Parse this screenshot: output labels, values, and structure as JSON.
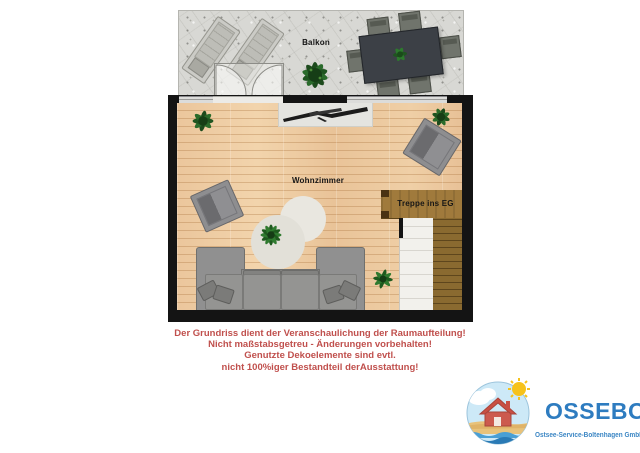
{
  "plan": {
    "labels": {
      "balcony": "Balkon",
      "living_room": "Wohnzimmer",
      "stairs": "Treppe ins EG"
    },
    "furniture": [
      "sun-lounger",
      "sun-lounger",
      "dining-table-with-6-chairs",
      "potted-plant",
      "tv-board",
      "armchair",
      "armchair",
      "round-rugs",
      "corner-sofa",
      "staircase-to-ground-floor"
    ]
  },
  "disclaimer": {
    "color": "#c0504d",
    "lines": [
      "Der Grundriss dient der Veranschaulichung der Raumaufteilung!",
      "Nicht maßstabsgetreu - Änderungen vorbehalten!",
      "Genutzte Dekoelemente sind evtl.",
      "nicht 100%iger Bestandteil derAusstattung!"
    ]
  },
  "logo": {
    "name": "OSSEBO",
    "subtitle": "Ostsee-Service-Boltenhagen GmbH",
    "color": "#2e7cc0"
  },
  "colors": {
    "wall": "#141414",
    "wood_floor": "#ecc9a1",
    "balcony_floor": "#d8d8d4",
    "stair_wood": "#a07a3c",
    "stair_flight": "#8a6a30",
    "sofa_gray": "#8f8f8d",
    "disclaimer_red": "#c0504d",
    "logo_blue": "#2e7cc0"
  }
}
